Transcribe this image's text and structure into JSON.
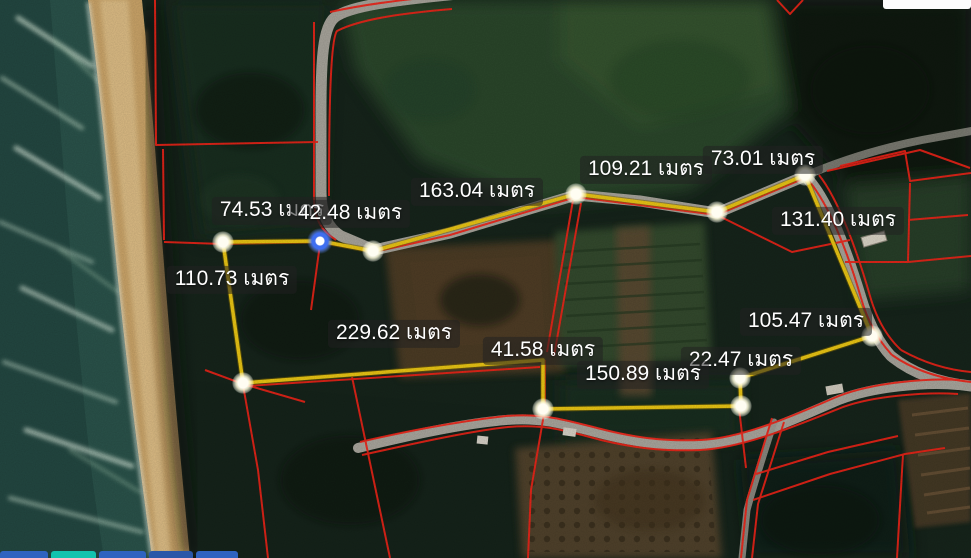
{
  "map": {
    "description": "Satellite map with cadastral parcel lines and a yellow land-measurement polygon",
    "unit": "เมตร",
    "measurements": [
      {
        "segment": "nw-1",
        "value": 74.53,
        "label": "74.53 เมตร"
      },
      {
        "segment": "nw-2",
        "value": 42.48,
        "label": "42.48 เมตร"
      },
      {
        "segment": "north-long",
        "value": 163.04,
        "label": "163.04 เมตร"
      },
      {
        "segment": "north-mid",
        "value": 109.21,
        "label": "109.21 เมตร"
      },
      {
        "segment": "north-east",
        "value": 73.01,
        "label": "73.01 เมตร"
      },
      {
        "segment": "east-upper",
        "value": 131.4,
        "label": "131.40 เมตร"
      },
      {
        "segment": "east-lower",
        "value": 105.47,
        "label": "105.47 เมตร"
      },
      {
        "segment": "south-step",
        "value": 22.47,
        "label": "22.47 เมตร"
      },
      {
        "segment": "south-mid",
        "value": 150.89,
        "label": "150.89 เมตร"
      },
      {
        "segment": "south-notch",
        "value": 41.58,
        "label": "41.58 เมตร"
      },
      {
        "segment": "south-long",
        "value": 229.62,
        "label": "229.62 เมตร"
      },
      {
        "segment": "west",
        "value": 110.73,
        "label": "110.73 เมตร"
      }
    ],
    "colors": {
      "measure_line": "#e8c414",
      "parcel_line": "#ee2418",
      "selected_marker": "#3e6ef0",
      "vertex_marker": "#fffdf2",
      "label_text": "#ffffff",
      "label_background": "rgba(33,33,33,0.55)",
      "sea": "#2a524a",
      "sand": "#c9a368",
      "road": "#a6a39a"
    },
    "bottom_bar": {
      "segments": [
        {
          "color": "#2f63c0"
        },
        {
          "color": "#12c3ae"
        },
        {
          "color": "#2f63c0"
        },
        {
          "color": "#2a57a8"
        },
        {
          "color": "#2f63c0"
        }
      ]
    }
  }
}
